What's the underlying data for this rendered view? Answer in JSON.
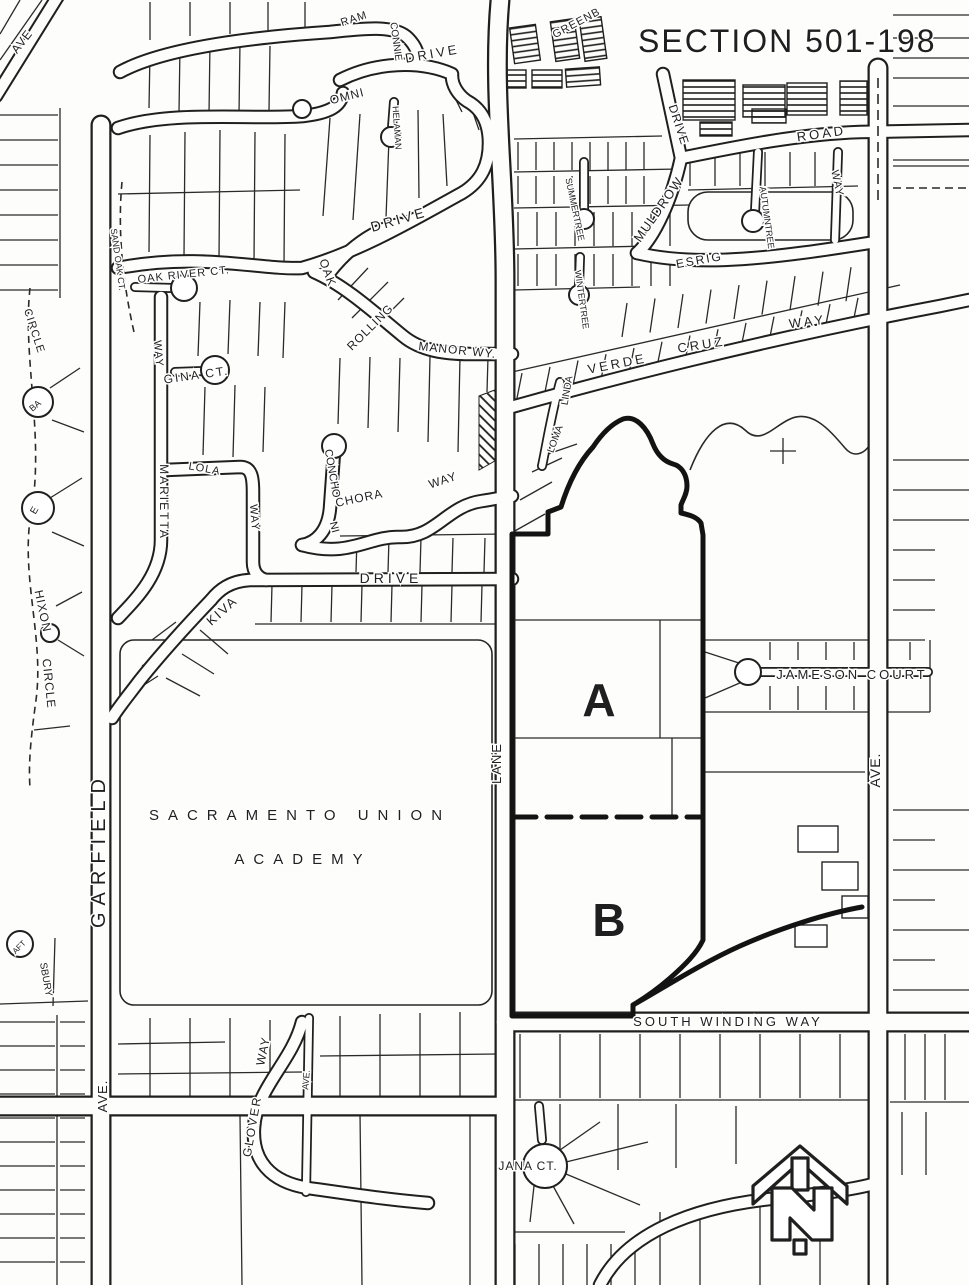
{
  "page": {
    "title": "SECTION 501-198"
  },
  "map": {
    "ink": "#1f1f1f",
    "paper": "#fdfdfb",
    "labels": [
      {
        "name": "section-title",
        "text": "SECTION 501-198",
        "x": 638,
        "y": 52,
        "rot": 0,
        "size": 32,
        "ls": 2,
        "anchor": "start"
      },
      {
        "name": "street-label-greenb",
        "text": "GREENB",
        "x": 578,
        "y": 26,
        "rot": -28,
        "size": 11,
        "ls": 1
      },
      {
        "name": "street-label-ram",
        "text": "RAM",
        "x": 355,
        "y": 22,
        "rot": -18,
        "size": 11,
        "ls": 1
      },
      {
        "name": "street-label-ave-northwest",
        "text": "AVE",
        "x": 25,
        "y": 44,
        "rot": -52,
        "size": 12,
        "ls": 1
      },
      {
        "name": "street-label-connie",
        "text": "CONNIE",
        "x": 393,
        "y": 42,
        "rot": 82,
        "size": 10,
        "ls": 0
      },
      {
        "name": "street-label-drive-northwest",
        "text": "DRIVE",
        "x": 433,
        "y": 58,
        "rot": -10,
        "size": 13,
        "ls": 3
      },
      {
        "name": "street-label-omni",
        "text": "OMNI",
        "x": 348,
        "y": 100,
        "rot": -14,
        "size": 12,
        "ls": 1
      },
      {
        "name": "street-label-helaman",
        "text": "HELAMAN",
        "x": 394,
        "y": 128,
        "rot": 86,
        "size": 9,
        "ls": 0
      },
      {
        "name": "street-label-drive-northeast",
        "text": "DRIVE",
        "x": 675,
        "y": 126,
        "rot": 72,
        "size": 12,
        "ls": 1
      },
      {
        "name": "street-label-road",
        "text": "ROAD",
        "x": 822,
        "y": 138,
        "rot": -8,
        "size": 13,
        "ls": 3
      },
      {
        "name": "street-label-way-northeast",
        "text": "WAY",
        "x": 834,
        "y": 184,
        "rot": 78,
        "size": 11,
        "ls": 1
      },
      {
        "name": "street-label-muldrow",
        "text": "MULDROW",
        "x": 662,
        "y": 212,
        "rot": -55,
        "size": 13,
        "ls": 1
      },
      {
        "name": "street-label-autumntree",
        "text": "AUTUMNTREE",
        "x": 764,
        "y": 218,
        "rot": 82,
        "size": 9,
        "ls": 0
      },
      {
        "name": "street-label-summertree",
        "text": "SUMMERTREE",
        "x": 572,
        "y": 210,
        "rot": 78,
        "size": 9,
        "ls": 0
      },
      {
        "name": "street-label-wintertree",
        "text": "WINTERTREE",
        "x": 579,
        "y": 300,
        "rot": 82,
        "size": 9,
        "ls": 0
      },
      {
        "name": "street-label-esrig",
        "text": "ESRIG",
        "x": 700,
        "y": 264,
        "rot": -10,
        "size": 12,
        "ls": 2
      },
      {
        "name": "street-label-drive-loop",
        "text": "DRIVE",
        "x": 400,
        "y": 224,
        "rot": -16,
        "size": 14,
        "ls": 3
      },
      {
        "name": "street-label-oak",
        "text": "OAK",
        "x": 324,
        "y": 274,
        "rot": 70,
        "size": 12,
        "ls": 1
      },
      {
        "name": "street-label-rolling",
        "text": "ROLLING",
        "x": 373,
        "y": 330,
        "rot": -45,
        "size": 12,
        "ls": 1
      },
      {
        "name": "street-label-manor-wy",
        "text": "MANOR WY.",
        "x": 457,
        "y": 354,
        "rot": 6,
        "size": 12,
        "ls": 1
      },
      {
        "name": "street-label-oak-river-ct",
        "text": "OAK RIVER CT.",
        "x": 184,
        "y": 278,
        "rot": -6,
        "size": 11,
        "ls": 1
      },
      {
        "name": "street-label-sand-oak-ct",
        "text": "SAND OAK CT.",
        "x": 115,
        "y": 260,
        "rot": 82,
        "size": 9,
        "ls": 0
      },
      {
        "name": "street-label-circle-northwest",
        "text": "CIRCLE",
        "x": 31,
        "y": 332,
        "rot": 72,
        "size": 11,
        "ls": 1
      },
      {
        "name": "street-label-way-marietta",
        "text": "WAY",
        "x": 155,
        "y": 354,
        "rot": 85,
        "size": 11,
        "ls": 1
      },
      {
        "name": "street-label-gina-ct",
        "text": "GINA CT.",
        "x": 197,
        "y": 379,
        "rot": -8,
        "size": 12,
        "ls": 2
      },
      {
        "name": "cul-de-sac-label-ba",
        "text": "BA",
        "x": 37,
        "y": 408,
        "rot": -40,
        "size": 9,
        "ls": 0
      },
      {
        "name": "street-label-marietta",
        "text": "MARIETTA",
        "x": 160,
        "y": 502,
        "rot": 90,
        "size": 12,
        "ls": 2
      },
      {
        "name": "street-label-lola",
        "text": "LOLA",
        "x": 204,
        "y": 472,
        "rot": 10,
        "size": 11,
        "ls": 1
      },
      {
        "name": "street-label-way-mid",
        "text": "WAY",
        "x": 251,
        "y": 518,
        "rot": 85,
        "size": 11,
        "ls": 1
      },
      {
        "name": "cul-de-sac-label-e",
        "text": "E",
        "x": 37,
        "y": 512,
        "rot": -60,
        "size": 10,
        "ls": 0
      },
      {
        "name": "street-label-concho",
        "text": "CONCHO",
        "x": 329,
        "y": 474,
        "rot": 80,
        "size": 11,
        "ls": 0
      },
      {
        "name": "street-label-ni",
        "text": "NI",
        "x": 331,
        "y": 528,
        "rot": 75,
        "size": 11,
        "ls": 0
      },
      {
        "name": "street-label-chora",
        "text": "CHORA",
        "x": 360,
        "y": 502,
        "rot": -12,
        "size": 12,
        "ls": 1
      },
      {
        "name": "street-label-way-nichora",
        "text": "WAY",
        "x": 444,
        "y": 484,
        "rot": -18,
        "size": 12,
        "ls": 1
      },
      {
        "name": "street-label-verde",
        "text": "VERDE",
        "x": 618,
        "y": 368,
        "rot": -11,
        "size": 13,
        "ls": 3
      },
      {
        "name": "street-label-cruz",
        "text": "CRUZ",
        "x": 702,
        "y": 349,
        "rot": -9,
        "size": 13,
        "ls": 3
      },
      {
        "name": "street-label-way-cruz",
        "text": "WAY",
        "x": 808,
        "y": 326,
        "rot": -7,
        "size": 13,
        "ls": 3
      },
      {
        "name": "street-label-linda",
        "text": "LINDA",
        "x": 570,
        "y": 391,
        "rot": -80,
        "size": 10,
        "ls": 0
      },
      {
        "name": "street-label-loma",
        "text": "LOMA",
        "x": 558,
        "y": 440,
        "rot": -70,
        "size": 10,
        "ls": 0
      },
      {
        "name": "street-label-hixon",
        "text": "HIXON",
        "x": 39,
        "y": 612,
        "rot": 78,
        "size": 12,
        "ls": 1
      },
      {
        "name": "street-label-hixon-circle",
        "text": "CIRCLE",
        "x": 45,
        "y": 684,
        "rot": 84,
        "size": 12,
        "ls": 1
      },
      {
        "name": "street-label-kiva",
        "text": "KIVA",
        "x": 225,
        "y": 614,
        "rot": -42,
        "size": 13,
        "ls": 2
      },
      {
        "name": "street-label-kiva-drive",
        "text": "DRIVE",
        "x": 391,
        "y": 583,
        "rot": 0,
        "size": 14,
        "ls": 4
      },
      {
        "name": "parcel-label-a",
        "text": "A",
        "x": 599,
        "y": 716,
        "rot": 0,
        "size": 46,
        "ls": 0,
        "bold": true
      },
      {
        "name": "street-label-jameson-court",
        "text": "JAMESON COURT",
        "x": 852,
        "y": 679,
        "rot": 0,
        "size": 13,
        "ls": 3
      },
      {
        "name": "street-label-lane",
        "text": "LANE",
        "x": 501,
        "y": 763,
        "rot": -90,
        "size": 13,
        "ls": 2
      },
      {
        "name": "street-label-ave-right",
        "text": "AVE.",
        "x": 880,
        "y": 770,
        "rot": -90,
        "size": 14,
        "ls": 1
      },
      {
        "name": "place-label-sacramento-union",
        "text": "SACRAMENTO UNION",
        "x": 300,
        "y": 820,
        "rot": 0,
        "size": 15,
        "ls": 9
      },
      {
        "name": "place-label-academy",
        "text": "ACADEMY",
        "x": 303,
        "y": 864,
        "rot": 0,
        "size": 15,
        "ls": 9
      },
      {
        "name": "street-label-garfield",
        "text": "GARFIELD",
        "x": 105,
        "y": 850,
        "rot": -90,
        "size": 20,
        "ls": 7
      },
      {
        "name": "parcel-label-b",
        "text": "B",
        "x": 609,
        "y": 936,
        "rot": 0,
        "size": 46,
        "ls": 0,
        "bold": true
      },
      {
        "name": "cul-de-sac-label-aft",
        "text": "AFT",
        "x": 21,
        "y": 949,
        "rot": -45,
        "size": 8,
        "ls": 0
      },
      {
        "name": "street-label-sbury",
        "text": "SBURY",
        "x": 43,
        "y": 980,
        "rot": 80,
        "size": 10,
        "ls": 0
      },
      {
        "name": "street-label-south-winding-way",
        "text": "SOUTH WINDING WAY",
        "x": 728,
        "y": 1026,
        "rot": 0,
        "size": 13,
        "ls": 3
      },
      {
        "name": "street-label-glover-way-suffix",
        "text": "WAY",
        "x": 267,
        "y": 1052,
        "rot": -78,
        "size": 12,
        "ls": 1
      },
      {
        "name": "street-label-ave-east-of-glover",
        "text": "AVE.",
        "x": 309,
        "y": 1080,
        "rot": -85,
        "size": 9,
        "ls": 0
      },
      {
        "name": "street-label-garfield-ave",
        "text": "AVE.",
        "x": 107,
        "y": 1096,
        "rot": -90,
        "size": 13,
        "ls": 1
      },
      {
        "name": "street-label-glover",
        "text": "GLOVER",
        "x": 256,
        "y": 1127,
        "rot": -80,
        "size": 12,
        "ls": 2
      },
      {
        "name": "street-label-jana-ct",
        "text": "JANA CT.",
        "x": 528,
        "y": 1170,
        "rot": 0,
        "size": 12,
        "ls": 1
      }
    ]
  }
}
